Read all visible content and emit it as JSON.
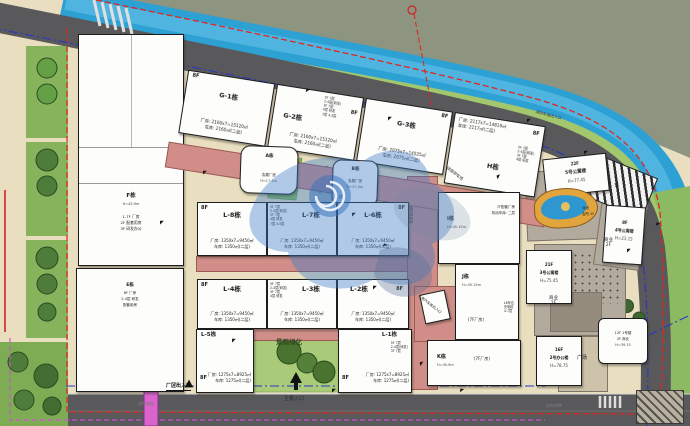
{
  "colors": {
    "site_beige": "#e9dfc0",
    "river_blue": "#2ea1d4",
    "road_gray": "#59595b",
    "hill_olive": "#8d947f",
    "podium_pink": "#d18e89",
    "landscape_green": "#a9cb79",
    "tree_green": "#4e7c3a",
    "boundary_red": "#e0251f",
    "boundary_blue": "#2b35c4",
    "boundary_magenta": "#cf52cf",
    "watermark_blue": "#3a7ac8",
    "pool_rim_orange": "#e2a43c"
  },
  "marker_glyph": "◤",
  "micro_notes": [
    "5F 7层",
    "2-4层(研发)",
    "3F 7层",
    "4层 研发",
    "7层 4.5层"
  ],
  "areas": {
    "landscape": "景观绿化",
    "shaded_parking": "绿荫停车场",
    "fire_access": "消防登高面",
    "garage_entry": "二类汽车库出入口",
    "fire_lane_entry": "消防车道出入口",
    "plaza": "广场",
    "biz": "商业",
    "biz_floor": "2F",
    "pool": "泳池",
    "club": "会所 2F"
  },
  "roads": {
    "factory_gate": "厂区出入口",
    "main_gate": "主要入口",
    "planned_road": "规划道路"
  },
  "b": {
    "f": {
      "name": "F栋",
      "height": "H=45.9m",
      "notes": [
        "1-7F 厂房",
        "2F 配套用房",
        "3F 研发办公"
      ]
    },
    "e": {
      "name": "E栋",
      "notes": [
        "8F 厂房",
        "2-4层 研发",
        "配套用房"
      ],
      "corner": "2F"
    },
    "g1": {
      "floors": "8F",
      "name": "G-1栋",
      "line1": "厂房: 2160x7=15120㎡",
      "line2": "车库: 2160㎡(二层)"
    },
    "g2": {
      "floors": "8F",
      "name": "G-2栋",
      "line1": "厂房: 2160x7=15120㎡",
      "line2": "车库: 2160㎡(二层)"
    },
    "g3": {
      "floors": "8F",
      "name": "G-3栋",
      "line1": "厂房: 2075x7=14525㎡",
      "line2": "车库: 2075㎡(二层)"
    },
    "h": {
      "floors": "8F",
      "name": "H栋",
      "line1": "厂房: 2117x7=14819㎡",
      "line2": "车库: 2117㎡(二层)"
    },
    "a": {
      "name": "A栋",
      "use": "会展厂房",
      "height": "H=17.3m"
    },
    "bb": {
      "name": "B栋",
      "use": "会展厂房",
      "height": "H=17.3m",
      "corner": "2F"
    },
    "l8": {
      "floors": "8F",
      "name": "L-8栋",
      "line1": "厂房: 1350x7=9450㎡",
      "line2": "车库: 1350㎡(二层)"
    },
    "l7": {
      "name": "L-7栋",
      "line1": "厂房: 1350x7=9450㎡",
      "line2": "车库: 1350㎡(二层)"
    },
    "l6": {
      "floors": "8F",
      "name": "L-6栋",
      "line1": "厂房: 1350x7=9450㎡",
      "line2": "车库: 1350㎡(二层)"
    },
    "l4": {
      "floors": "8F",
      "name": "L-4栋",
      "line1": "厂房: 1350x7=9450㎡",
      "line2": "车库: 1350㎡(二层)"
    },
    "l3": {
      "name": "L-3栋",
      "line1": "厂房: 1350x7=9450㎡",
      "line2": "车库: 1350㎡(二层)"
    },
    "l2": {
      "floors": "8F",
      "name": "L-2栋",
      "line1": "厂房: 1350x7=9450㎡",
      "line2": "车库: 1350㎡(二层)"
    },
    "l5": {
      "floors": "8F",
      "name": "L-5栋",
      "line1": "厂房: 1275x7=8925㎡",
      "line2": "车库: 1275㎡(二层)"
    },
    "l1": {
      "floors": "8F",
      "name": "L-1栋",
      "line1": "厂房: 1275x7=8925㎡",
      "line2": "车库: 1275㎡(二层)"
    },
    "i": {
      "name": "I栋",
      "height": "H=45.15m",
      "notes": [
        "7F配套厂房",
        "机动车库: 二层"
      ]
    },
    "j": {
      "name": "J栋",
      "height": "H=45.15m",
      "tag": "(7F厂房)",
      "notes": [
        "L6车位",
        "充电桩",
        "4-7层"
      ]
    },
    "k": {
      "name": "K栋",
      "height": "H=45.9m",
      "tag": "(7F厂房)"
    },
    "apt5": {
      "floors": "22F",
      "name": "5号公寓楼",
      "height": "H=77.45"
    },
    "apt4": {
      "floors": "8F",
      "name": "4号公寓楼",
      "height": "H=23.15",
      "tag": "1F"
    },
    "apt3": {
      "floors": "21F",
      "name": "3号公寓楼",
      "height": "H=75.45"
    },
    "off2": {
      "floors": "16F",
      "name": "2号办公楼",
      "height": "H=78.75"
    },
    "b1": {
      "notes": [
        "12F 1号楼",
        "2F 商业",
        "H=39.15"
      ]
    }
  }
}
